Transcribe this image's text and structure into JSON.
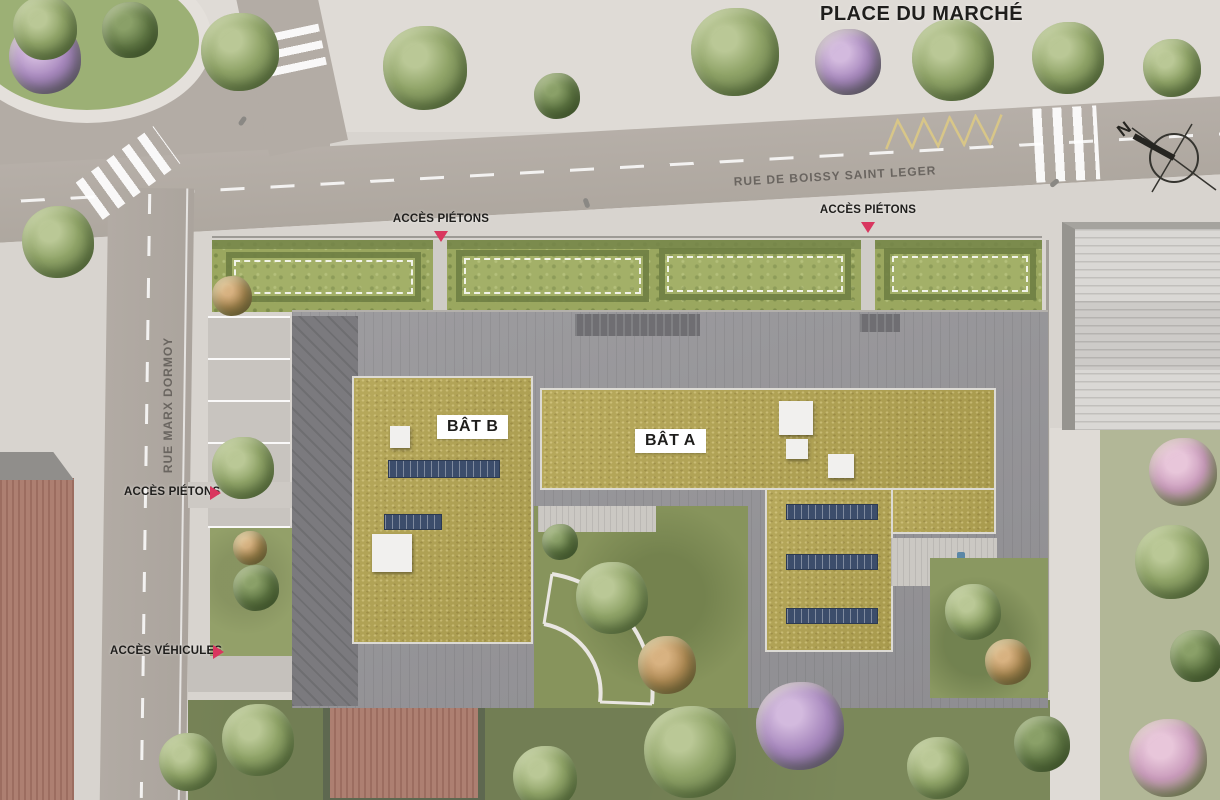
{
  "plaza": {
    "label": "PLACE DU MARCHÉ"
  },
  "streets": {
    "boissy": "RUE DE BOISSY SAINT LEGER",
    "marx_dormoy": "RUE MARX DORMOY"
  },
  "buildings": {
    "bat_a": "BÂT A",
    "bat_b": "BÂT B"
  },
  "access": {
    "pedestrian_top_left": "ACCÈS PIÉTONS",
    "pedestrian_top_right": "ACCÈS PIÉTONS",
    "pedestrian_west": "ACCÈS PIÉTONS",
    "vehicle_west": "ACCÈS VÉHICULES"
  },
  "compass": {
    "north": "N"
  },
  "colors": {
    "accent_marker": "#d9365f",
    "sedum_roof": "#b1a257",
    "gray_roof": "#97969a",
    "road": "#b3aca5",
    "pavement": "#d8d4cf",
    "lawn": "#7b885a",
    "garden_strip": "#9aa75f",
    "solar_panel": "#3c4d6b",
    "red_tile_roof": "#a8766a",
    "zigzag_marking": "#d8c688"
  }
}
